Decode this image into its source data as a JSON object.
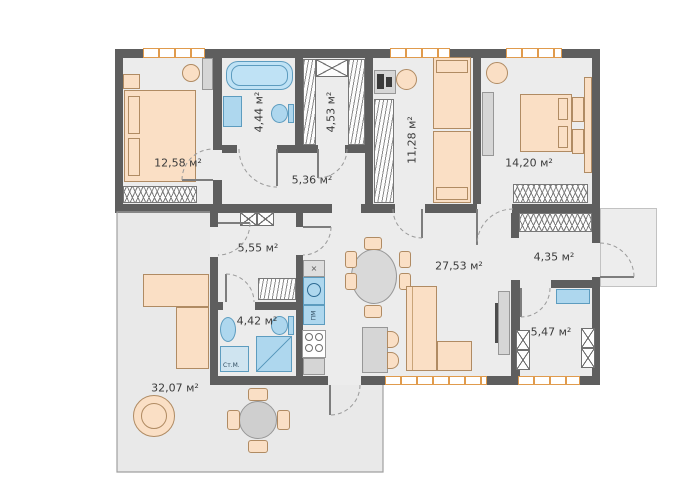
{
  "rooms": [
    {
      "id": "bedroom-1",
      "area_label": "12,58 м²"
    },
    {
      "id": "bathroom-1",
      "area_label": "4,44 м²"
    },
    {
      "id": "wardrobe-room",
      "area_label": "4,53 м²"
    },
    {
      "id": "hallway",
      "area_label": "5,36 м²"
    },
    {
      "id": "kids-room",
      "area_label": "11,28 м²"
    },
    {
      "id": "bedroom-2",
      "area_label": "14,20 м²"
    },
    {
      "id": "corridor",
      "area_label": "5,55 м²"
    },
    {
      "id": "living-room",
      "area_label": "27,53 м²"
    },
    {
      "id": "entry-hall",
      "area_label": "4,35 м²"
    },
    {
      "id": "office",
      "area_label": "5,47 м²"
    },
    {
      "id": "bathroom-2",
      "area_label": "4,42 м²"
    },
    {
      "id": "terrace",
      "area_label": "32,07 м²"
    }
  ],
  "appliance_labels": {
    "washing_machine": "Ст.М.",
    "dishwasher": "ПМ",
    "hood": "×"
  },
  "colors": {
    "wall": "#5e5e5e",
    "room_fill": "#ececec",
    "terrace_fill": "#e9e9e9",
    "furniture": "#fadfc5",
    "furniture_border": "#b08b63",
    "plumbing": "#aed7ee",
    "window_accent": "#e09b4d"
  }
}
